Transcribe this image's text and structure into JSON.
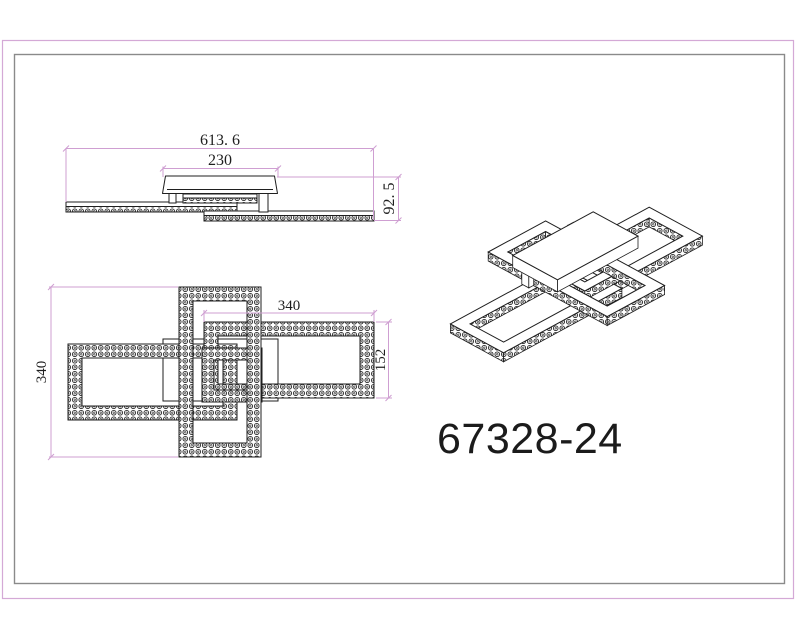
{
  "drawing": {
    "product_code": "67328-24",
    "side_view": {
      "dim_overall_width": "613. 6",
      "dim_canopy_width": "230",
      "dim_height": "92. 5"
    },
    "top_view": {
      "dim_frame_length": "340",
      "dim_right_frame_length": "340",
      "dim_right_frame_width": "152"
    }
  },
  "colors": {
    "dimension_pink": "#cf9fd2",
    "outer_border_pink": "#d4a9d6",
    "inner_border_gray": "#8a8a8a",
    "line_ink": "#1f1f1f"
  }
}
